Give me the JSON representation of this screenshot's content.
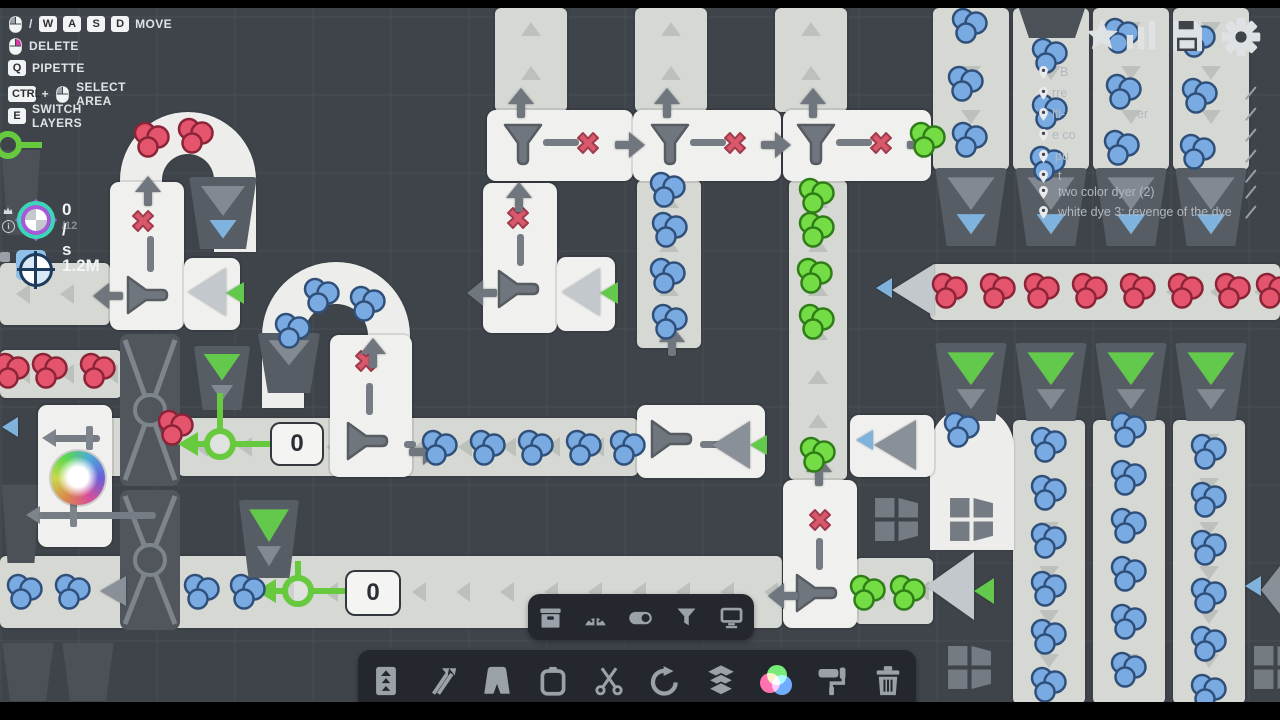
{
  "colors": {
    "bg": "#3f444b",
    "belt": "#d6d8d4",
    "tile": "#f0f0ee",
    "machine_gray": "#70767d",
    "x_red": "#d9596c",
    "counter_green": "#67c93e",
    "tri_blue": "#7fb2dd",
    "tri_green": "#63c94c",
    "berry_blue": "#79abe2",
    "berry_red": "#e4546c",
    "berry_green": "#74dd45",
    "toolbar_bg": "#24282e",
    "icon": "#9aa1a8",
    "hud_icon": "#e2e5e8"
  },
  "legend": {
    "rows": [
      {
        "tokens": [
          {
            "t": "mouse",
            "btn": "left"
          },
          {
            "t": "txt",
            "v": "/"
          },
          {
            "t": "key",
            "v": "W"
          },
          {
            "t": "key",
            "v": "A"
          },
          {
            "t": "key",
            "v": "S"
          },
          {
            "t": "key",
            "v": "D"
          }
        ],
        "label": "MOVE"
      },
      {
        "tokens": [
          {
            "t": "mouse",
            "btn": "right"
          }
        ],
        "label": "DELETE"
      },
      {
        "tokens": [
          {
            "t": "key",
            "v": "Q"
          }
        ],
        "label": "PIPETTE"
      },
      {
        "tokens": [
          {
            "t": "key",
            "v": "CTRL"
          },
          {
            "t": "txt",
            "v": "+"
          },
          {
            "t": "mouse",
            "btn": "left"
          }
        ],
        "label": "SELECT AREA"
      },
      {
        "tokens": [
          {
            "t": "key",
            "v": "E"
          }
        ],
        "label": "SWITCH LAYERS"
      }
    ]
  },
  "stats": {
    "rate": "0 / s",
    "cap": "/12",
    "money": "1.2M"
  },
  "hud_icons": [
    {
      "name": "star",
      "x": 1083,
      "s": 38
    },
    {
      "name": "stats",
      "x": 1122,
      "s": 38
    },
    {
      "name": "save",
      "x": 1167,
      "s": 40
    },
    {
      "name": "settings",
      "x": 1220,
      "s": 42
    }
  ],
  "markers": {
    "pin_x": 1036,
    "pencil_x": 1243,
    "rows": [
      {
        "y": 64,
        "pencil": false,
        "frags": [
          {
            "x": 1060,
            "t": "B"
          }
        ]
      },
      {
        "y": 85,
        "pencil": true,
        "frags": [
          {
            "x": 1052,
            "t": "rre"
          }
        ]
      },
      {
        "y": 106,
        "pencil": true,
        "frags": [
          {
            "x": 1052,
            "t": "lti-"
          },
          {
            "x": 1137,
            "t": "er"
          }
        ]
      },
      {
        "y": 127,
        "pencil": true,
        "frags": [
          {
            "x": 1052,
            "t": "e co"
          }
        ]
      },
      {
        "y": 148,
        "pencil": true,
        "frags": [
          {
            "x": 1055,
            "t": "pu"
          }
        ]
      },
      {
        "y": 168,
        "pencil": true,
        "frags": [
          {
            "x": 1058,
            "t": "t"
          }
        ]
      },
      {
        "y": 184,
        "pencil": true,
        "frags": [
          {
            "x": 1058,
            "t": "two color dyer (2)"
          }
        ]
      },
      {
        "y": 204,
        "pencil": true,
        "frags": [
          {
            "x": 1058,
            "t": "white dye 3: revenge of the dye"
          }
        ]
      }
    ]
  },
  "toolbars": {
    "small": {
      "x": 528,
      "y": 594,
      "w": 226,
      "h": 46,
      "icons": [
        "storage",
        "gauge",
        "toggle",
        "filter",
        "display"
      ]
    },
    "main": {
      "x": 358,
      "y": 650,
      "w": 558,
      "h": 62,
      "icons": [
        "belt-elevator",
        "shuffle",
        "tunnel",
        "clipboard",
        "scissors",
        "rotate",
        "layers",
        "colors",
        "paint-roller",
        "trash"
      ]
    }
  },
  "board": {
    "belts": [
      [
        0,
        263,
        110,
        62,
        "left"
      ],
      [
        0,
        350,
        122,
        48,
        "left"
      ],
      [
        0,
        556,
        782,
        72,
        "left"
      ],
      [
        55,
        418,
        70,
        58,
        "left"
      ],
      [
        178,
        418,
        460,
        58,
        "left"
      ],
      [
        495,
        8,
        72,
        104,
        "up"
      ],
      [
        635,
        8,
        72,
        104,
        "up"
      ],
      [
        775,
        8,
        72,
        104,
        "up"
      ],
      [
        637,
        180,
        64,
        168,
        "up"
      ],
      [
        789,
        180,
        58,
        300,
        "up"
      ],
      [
        855,
        558,
        78,
        66,
        "left"
      ],
      [
        933,
        8,
        76,
        162,
        "down"
      ],
      [
        1013,
        8,
        76,
        162,
        "down"
      ],
      [
        1093,
        8,
        76,
        162,
        "down"
      ],
      [
        1173,
        8,
        76,
        162,
        "down"
      ],
      [
        930,
        264,
        350,
        56,
        "left"
      ],
      [
        1013,
        420,
        72,
        284,
        "down"
      ],
      [
        1093,
        420,
        72,
        284,
        "down"
      ],
      [
        1173,
        420,
        72,
        284,
        "down"
      ]
    ],
    "arches": [
      [
        120,
        112,
        136,
        70
      ],
      [
        262,
        262,
        148,
        76
      ],
      [
        930,
        406,
        84,
        74
      ]
    ],
    "traps": [
      [
        0,
        150,
        42,
        85
      ],
      [
        0,
        485,
        42,
        78
      ],
      [
        0,
        643,
        56,
        58
      ],
      [
        60,
        643,
        56,
        58
      ],
      [
        1016,
        8,
        72,
        30
      ]
    ],
    "hoppers": [
      [
        187,
        177,
        72,
        72,
        [
          "gray",
          "blue"
        ]
      ],
      [
        192,
        346,
        60,
        64,
        [
          "green",
          "gray"
        ]
      ],
      [
        256,
        333,
        66,
        60,
        [
          "gray"
        ]
      ],
      [
        237,
        500,
        64,
        78,
        [
          "green",
          "gray"
        ]
      ],
      [
        933,
        168,
        76,
        78,
        [
          "gray",
          "blue"
        ]
      ],
      [
        1013,
        168,
        76,
        78,
        [
          "gray",
          "blue"
        ]
      ],
      [
        1093,
        168,
        76,
        78,
        [
          "gray",
          "blue"
        ]
      ],
      [
        1173,
        168,
        76,
        78,
        [
          "gray",
          "blue"
        ]
      ],
      [
        933,
        343,
        76,
        78,
        [
          "green",
          "gray"
        ]
      ],
      [
        1013,
        343,
        76,
        78,
        [
          "green",
          "gray"
        ]
      ],
      [
        1093,
        343,
        76,
        78,
        [
          "green",
          "gray"
        ]
      ],
      [
        1173,
        343,
        76,
        78,
        [
          "green",
          "gray"
        ]
      ]
    ],
    "crossings": [
      [
        120,
        334,
        60,
        152
      ],
      [
        120,
        490,
        60,
        140
      ]
    ],
    "tiles": [
      [
        487,
        110,
        146,
        71
      ],
      [
        633,
        110,
        148,
        71
      ],
      [
        783,
        110,
        148,
        71
      ],
      [
        110,
        182,
        74,
        148
      ],
      [
        184,
        258,
        56,
        72
      ],
      [
        483,
        183,
        74,
        150
      ],
      [
        557,
        257,
        58,
        74
      ],
      [
        330,
        335,
        82,
        142
      ],
      [
        637,
        405,
        128,
        73
      ],
      [
        783,
        480,
        74,
        148
      ],
      [
        850,
        415,
        84,
        62
      ],
      [
        38,
        405,
        74,
        142
      ]
    ],
    "pipes": [
      [
        42,
        426,
        58
      ],
      [
        26,
        503,
        130
      ]
    ],
    "funnels": [
      [
        501,
        122,
        0
      ],
      [
        648,
        122,
        0
      ],
      [
        794,
        122,
        0
      ],
      [
        126,
        272,
        -90
      ],
      [
        497,
        266,
        -90
      ],
      [
        346,
        418,
        -90
      ],
      [
        650,
        416,
        -90
      ],
      [
        795,
        570,
        -90
      ]
    ],
    "bars": [
      [
        543,
        139,
        36,
        7
      ],
      [
        690,
        139,
        36,
        7
      ],
      [
        836,
        139,
        36,
        7
      ],
      [
        147,
        236,
        7,
        36
      ],
      [
        517,
        234,
        7,
        32
      ],
      [
        366,
        383,
        7,
        32
      ],
      [
        816,
        538,
        7,
        32
      ],
      [
        700,
        441,
        22,
        7
      ],
      [
        404,
        441,
        12,
        7
      ]
    ],
    "xmarks": [
      [
        574,
        129
      ],
      [
        721,
        129
      ],
      [
        867,
        129
      ],
      [
        129,
        207
      ],
      [
        504,
        204
      ],
      [
        352,
        347
      ],
      [
        806,
        506
      ]
    ],
    "arrows": [
      [
        508,
        88,
        "up"
      ],
      [
        654,
        88,
        "up"
      ],
      [
        800,
        88,
        "up"
      ],
      [
        135,
        176,
        "up"
      ],
      [
        506,
        182,
        "up"
      ],
      [
        360,
        338,
        "up"
      ],
      [
        659,
        326,
        "up"
      ],
      [
        806,
        456,
        "up"
      ],
      [
        96,
        280,
        "left"
      ],
      [
        470,
        277,
        "left"
      ],
      [
        771,
        580,
        "left"
      ],
      [
        616,
        129,
        "right"
      ],
      [
        762,
        129,
        "right"
      ],
      [
        908,
        129,
        "right"
      ],
      [
        410,
        436,
        "right"
      ]
    ],
    "tris": [
      [
        "light",
        188,
        268,
        38,
        48
      ],
      [
        "green",
        226,
        282,
        18,
        22
      ],
      [
        "light",
        562,
        268,
        38,
        48
      ],
      [
        "green",
        600,
        282,
        18,
        22
      ],
      [
        "gray",
        712,
        421,
        38,
        48
      ],
      [
        "green",
        750,
        435,
        17,
        21
      ],
      [
        "blue",
        856,
        430,
        17,
        21
      ],
      [
        "gray",
        874,
        420,
        42,
        50
      ],
      [
        "blue",
        876,
        278,
        16,
        20
      ],
      [
        "light",
        892,
        264,
        42,
        52
      ],
      [
        "light",
        926,
        552,
        48,
        68
      ],
      [
        "green",
        974,
        578,
        20,
        26
      ],
      [
        "blue",
        1245,
        576,
        16,
        20
      ],
      [
        "gray",
        1261,
        566,
        19,
        48
      ],
      [
        "blue",
        2,
        417,
        16,
        20
      ],
      [
        "gray",
        100,
        576,
        26,
        30
      ]
    ],
    "counters": [
      [
        220,
        444,
        36,
        37
      ],
      [
        298,
        591,
        15,
        34
      ]
    ],
    "grings": [
      [
        -6,
        131
      ]
    ],
    "windmills": [
      [
        873,
        496
      ],
      [
        948,
        496
      ],
      [
        946,
        644
      ],
      [
        1252,
        644
      ]
    ],
    "balls": [
      [
        78,
        478,
        27
      ]
    ],
    "zboxes": [
      {
        "x": 272,
        "y": 424,
        "w": 50,
        "h": 40,
        "v": "0"
      },
      {
        "x": 347,
        "y": 572,
        "w": 52,
        "h": 42,
        "v": "0"
      }
    ],
    "berries": [
      [
        668,
        190,
        "blue"
      ],
      [
        670,
        230,
        "blue"
      ],
      [
        668,
        276,
        "blue"
      ],
      [
        670,
        322,
        "blue"
      ],
      [
        440,
        448,
        "blue"
      ],
      [
        488,
        448,
        "blue"
      ],
      [
        536,
        448,
        "blue"
      ],
      [
        584,
        448,
        "blue"
      ],
      [
        628,
        448,
        "blue"
      ],
      [
        25,
        592,
        "blue"
      ],
      [
        73,
        592,
        "blue"
      ],
      [
        202,
        592,
        "blue"
      ],
      [
        248,
        592,
        "blue"
      ],
      [
        322,
        296,
        "blue"
      ],
      [
        368,
        304,
        "blue"
      ],
      [
        293,
        331,
        "blue"
      ],
      [
        962,
        430,
        "blue"
      ],
      [
        970,
        26,
        "blue"
      ],
      [
        966,
        84,
        "blue"
      ],
      [
        970,
        140,
        "blue"
      ],
      [
        1050,
        56,
        "blue"
      ],
      [
        1050,
        112,
        "blue"
      ],
      [
        1048,
        164,
        "blue"
      ],
      [
        1122,
        36,
        "blue"
      ],
      [
        1124,
        92,
        "blue"
      ],
      [
        1122,
        148,
        "blue"
      ],
      [
        1198,
        40,
        "blue"
      ],
      [
        1200,
        96,
        "blue"
      ],
      [
        1198,
        152,
        "blue"
      ],
      [
        1049,
        445,
        "blue"
      ],
      [
        1049,
        493,
        "blue"
      ],
      [
        1049,
        541,
        "blue"
      ],
      [
        1049,
        589,
        "blue"
      ],
      [
        1049,
        637,
        "blue"
      ],
      [
        1049,
        685,
        "blue"
      ],
      [
        1129,
        430,
        "blue"
      ],
      [
        1129,
        478,
        "blue"
      ],
      [
        1129,
        526,
        "blue"
      ],
      [
        1129,
        574,
        "blue"
      ],
      [
        1129,
        622,
        "blue"
      ],
      [
        1129,
        670,
        "blue"
      ],
      [
        1209,
        452,
        "blue"
      ],
      [
        1209,
        500,
        "blue"
      ],
      [
        1209,
        548,
        "blue"
      ],
      [
        1209,
        596,
        "blue"
      ],
      [
        1209,
        644,
        "blue"
      ],
      [
        1209,
        692,
        "blue"
      ],
      [
        152,
        140,
        "red"
      ],
      [
        196,
        136,
        "red"
      ],
      [
        12,
        371,
        "red"
      ],
      [
        50,
        371,
        "red"
      ],
      [
        98,
        371,
        "red"
      ],
      [
        176,
        428,
        "red"
      ],
      [
        950,
        291,
        "red"
      ],
      [
        998,
        291,
        "red"
      ],
      [
        1042,
        291,
        "red"
      ],
      [
        1090,
        291,
        "red"
      ],
      [
        1138,
        291,
        "red"
      ],
      [
        1186,
        291,
        "red"
      ],
      [
        1233,
        291,
        "red"
      ],
      [
        1274,
        291,
        "red"
      ],
      [
        817,
        196,
        "green"
      ],
      [
        817,
        230,
        "green"
      ],
      [
        815,
        276,
        "green"
      ],
      [
        817,
        322,
        "green"
      ],
      [
        818,
        455,
        "green"
      ],
      [
        868,
        593,
        "green"
      ],
      [
        908,
        593,
        "green"
      ],
      [
        928,
        140,
        "green"
      ]
    ]
  }
}
